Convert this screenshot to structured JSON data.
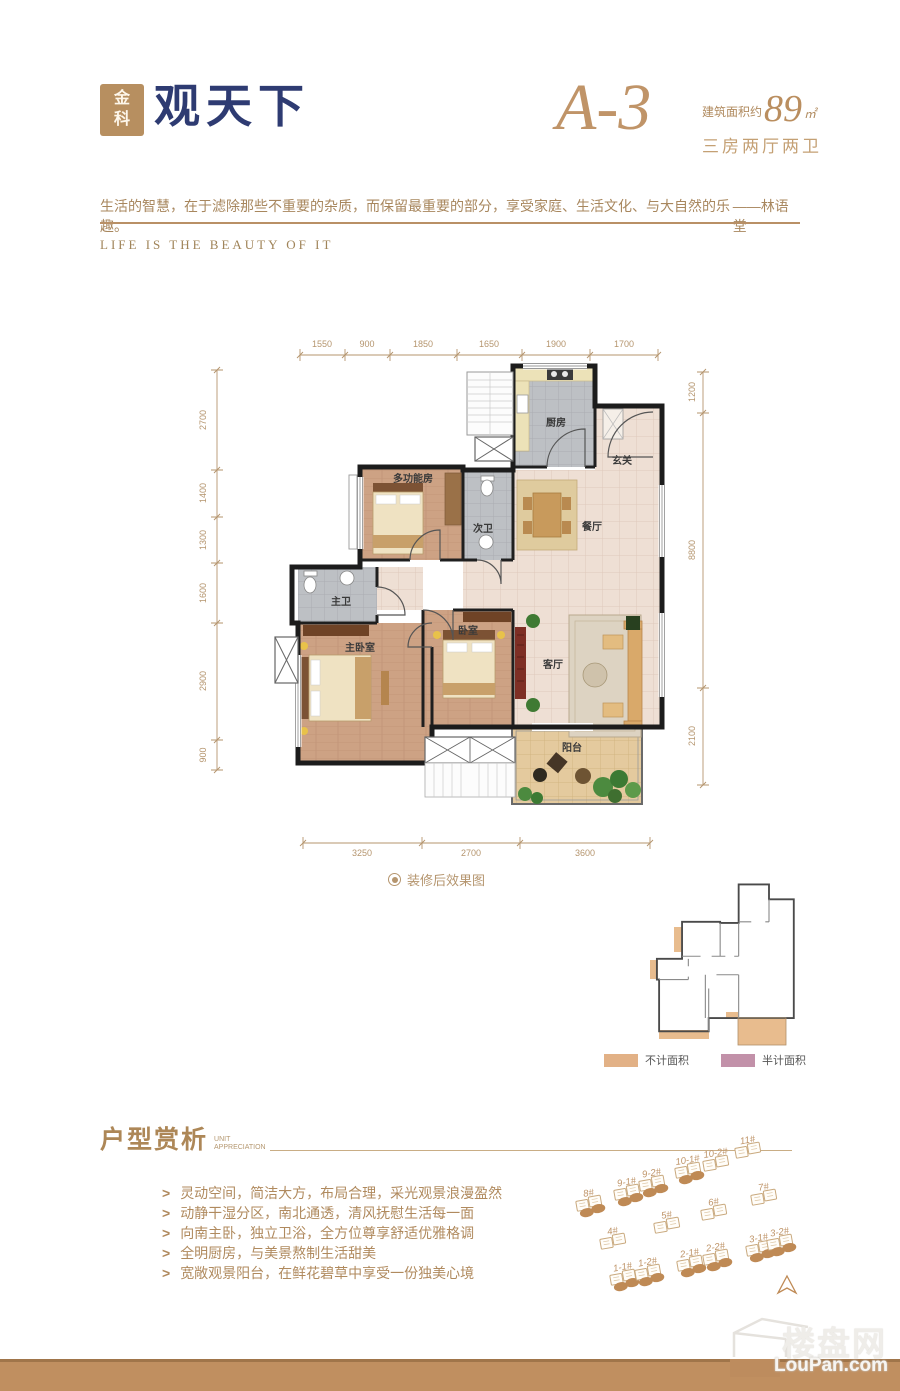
{
  "brand": {
    "logo_mark": "金科",
    "logo_name": "观天下"
  },
  "unit": {
    "code": "A-3",
    "area_label": "建筑面积约",
    "area_value": "89",
    "area_unit": "㎡",
    "rooms_summary": "三房两厅两卫"
  },
  "quote": {
    "text": "生活的智慧，在于滤除那些不重要的杂质，而保留最重要的部分，享受家庭、生活文化、与大自然的乐趣。",
    "author": "——林语堂",
    "slogan": "LIFE IS THE BEAUTY OF IT"
  },
  "floorplan": {
    "caption": "装修后效果图",
    "rooms": {
      "kitchen": "厨房",
      "foyer": "玄关",
      "dining": "餐厅",
      "multi_room": "多功能房",
      "second_bath": "次卫",
      "master_bath": "主卫",
      "master_bedroom": "主卧室",
      "bedroom": "卧室",
      "living": "客厅",
      "balcony": "阳台"
    },
    "dims_top": [
      "1550",
      "900",
      "1850",
      "1650",
      "1900",
      "1700"
    ],
    "dims_left": [
      "2700",
      "1400",
      "1300",
      "1600",
      "2900",
      "900"
    ],
    "dims_right": [
      "1200",
      "8800",
      "2100"
    ],
    "dims_bottom": [
      "3250",
      "2700",
      "3600"
    ]
  },
  "legend": {
    "not_counted": {
      "label": "不计面积",
      "color": "#e2b186"
    },
    "half_counted": {
      "label": "半计面积",
      "color": "#c291a9"
    }
  },
  "analysis": {
    "title": "户型赏析",
    "subtitle": [
      "UNIT",
      "APPRECIATION"
    ],
    "points": [
      "灵动空间，简洁大方，布局合理，采光观景浪漫盈然",
      "动静干湿分区，南北通透，清风抚慰生活每一面",
      "向南主卧，独立卫浴，全方位尊享舒适优雅格调",
      "全明厨房，与美景熬制生活甜美",
      "宽敞观景阳台，在鲜花碧草中享受一份独美心境"
    ]
  },
  "siteplan": {
    "buildings": [
      {
        "label": "8#"
      },
      {
        "label": "9-1#"
      },
      {
        "label": "9-2#"
      },
      {
        "label": "10-1#"
      },
      {
        "label": "10-2#"
      },
      {
        "label": "11#"
      },
      {
        "label": "7#"
      },
      {
        "label": "6#"
      },
      {
        "label": "5#"
      },
      {
        "label": "4#"
      },
      {
        "label": "3-1#"
      },
      {
        "label": "3-2#"
      },
      {
        "label": "2-1#"
      },
      {
        "label": "2-2#"
      },
      {
        "label": "1-1#"
      },
      {
        "label": "1-2#"
      }
    ]
  },
  "watermark": {
    "cn": "楼盘网",
    "en": "LouPan.com"
  },
  "colors": {
    "accent": "#b08a5e",
    "navy": "#2e3b72",
    "footer_bar": "#c08f60",
    "dim_lines": "#b5956e"
  }
}
